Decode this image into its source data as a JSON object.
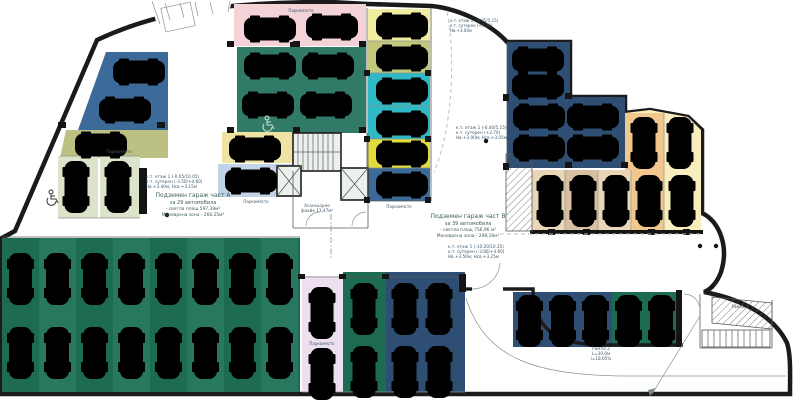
{
  "colors": {
    "floor": "#e0e6e2",
    "wall": "#1b1b1b",
    "pink": "#f3d2d8",
    "pink_light": "#eedff0",
    "green_dark": "#1e6b53",
    "green_dark2": "#27785f",
    "green_top": "#1f6f5a",
    "blue": "#3d6b99",
    "blue_dark": "#2e4e74",
    "cyan": "#2fb9c6",
    "yellow_pale": "#f0eca0",
    "yellow_bright": "#e2dd3b",
    "olive": "#c3c77b",
    "khaki": "#bcc083",
    "pad_green": "#dbe4ca",
    "yellow_zone": "#f8eebd",
    "orange": "#f1c78e",
    "tan": "#e9d6b7",
    "tan_dark": "#d8bfa0",
    "lavender": "#c2d3e7",
    "yellow_pad": "#efe3a3"
  },
  "labels": {
    "garage_a": [
      "Подземен гараж част А",
      "за 29 автомобила",
      "- светла площ 597,39м²",
      "Маневрена зона - 266,25м²"
    ],
    "garage_a_levels": [
      "к.т. етаж 1 (-0.05/10.05)",
      "к.т. сутерен (-3.50/+4.60)",
      "Нв.+3.40м; Нсв.+3.15м"
    ],
    "garage_b": [
      "Подземен гараж част В",
      "за 39 автомобила",
      "- светла площ 756,96 м²",
      "Маневрена зона - 298,16м²"
    ],
    "garage_b_levels": [
      "к.т. етаж 1 (-10.20/10.35)",
      "к.т. сутерен (-3.80/+4.60)",
      "Нв.+3.50м; Нсв.+3.25м"
    ],
    "levels_right": [
      "к.т. етаж 1 (-0.40/5.15)",
      "к.т. сутерен (+3.70)",
      "Нв.+3.00м; Нсв.+3.05м"
    ],
    "levels_top": [
      "к.т. етаж 1 (-0.05/5.15)",
      "к.т. сутерен (+3.70)",
      "Нв.+3.00м"
    ],
    "ramp2": [
      "Рампа 2",
      "L=30.0м",
      "i=18.05%"
    ],
    "ramp1": "Рампа 1",
    "lobby": [
      "Асансьорно",
      "фоайе 13,47м²"
    ],
    "spot": "Паркомясто"
  }
}
